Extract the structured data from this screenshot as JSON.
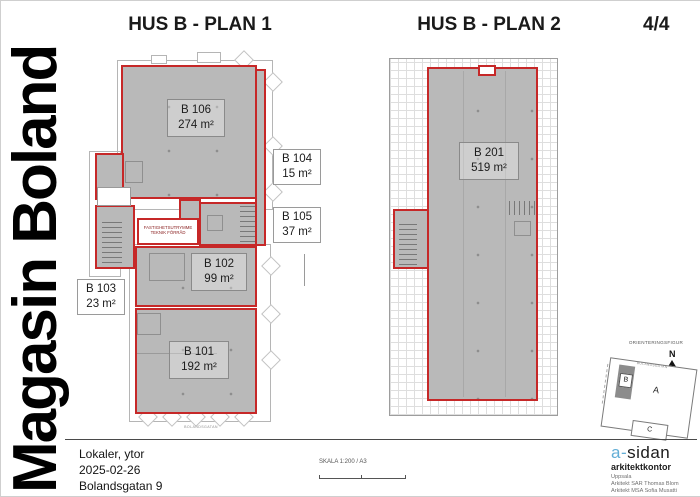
{
  "page": {
    "vertical_title": "Magasin Boland",
    "page_number": "4/4"
  },
  "plan1": {
    "title": "HUS B - PLAN 1",
    "street_label": "BOLANDSGATAN",
    "rooms": {
      "b106": {
        "id": "B 106",
        "area": "274 m²"
      },
      "b104": {
        "id": "B 104",
        "area": "15 m²"
      },
      "b105": {
        "id": "B 105",
        "area": "37 m²"
      },
      "b102": {
        "id": "B 102",
        "area": "99 m²"
      },
      "b103": {
        "id": "B 103",
        "area": "23 m²"
      },
      "b101": {
        "id": "B 101",
        "area": "192 m²"
      }
    },
    "technical_room": {
      "line1": "FASTIGHETSUTRYMME",
      "line2": "TEKNIK FÖRRÅD"
    }
  },
  "plan2": {
    "title": "HUS B - PLAN 2",
    "rooms": {
      "b201": {
        "id": "B 201",
        "area": "519 m²"
      }
    }
  },
  "orientation": {
    "label": "ORIENTERINGSFIGUR",
    "north": "N",
    "buildings": {
      "a": "A",
      "b": "B",
      "c": "C"
    },
    "street": "BOLANDSGATAN"
  },
  "footer": {
    "doc_lines": [
      "Lokaler, ytor",
      "2025-02-26",
      "Bolandsgatan 9"
    ],
    "scale_label": "SKALA 1:200 / A3",
    "firm": {
      "logo_a": "a-",
      "logo_rest": "sidan",
      "type": "arkitektkontor",
      "city": "Uppsala",
      "architect1": "Arkitekt SAR Thomas Blom",
      "architect2": "Arkitekt MSA Sofia Musatti"
    }
  },
  "colors": {
    "outline_red": "#c62828",
    "fill_gray": "#b9b9b9",
    "logo_blue": "#62aed6"
  }
}
